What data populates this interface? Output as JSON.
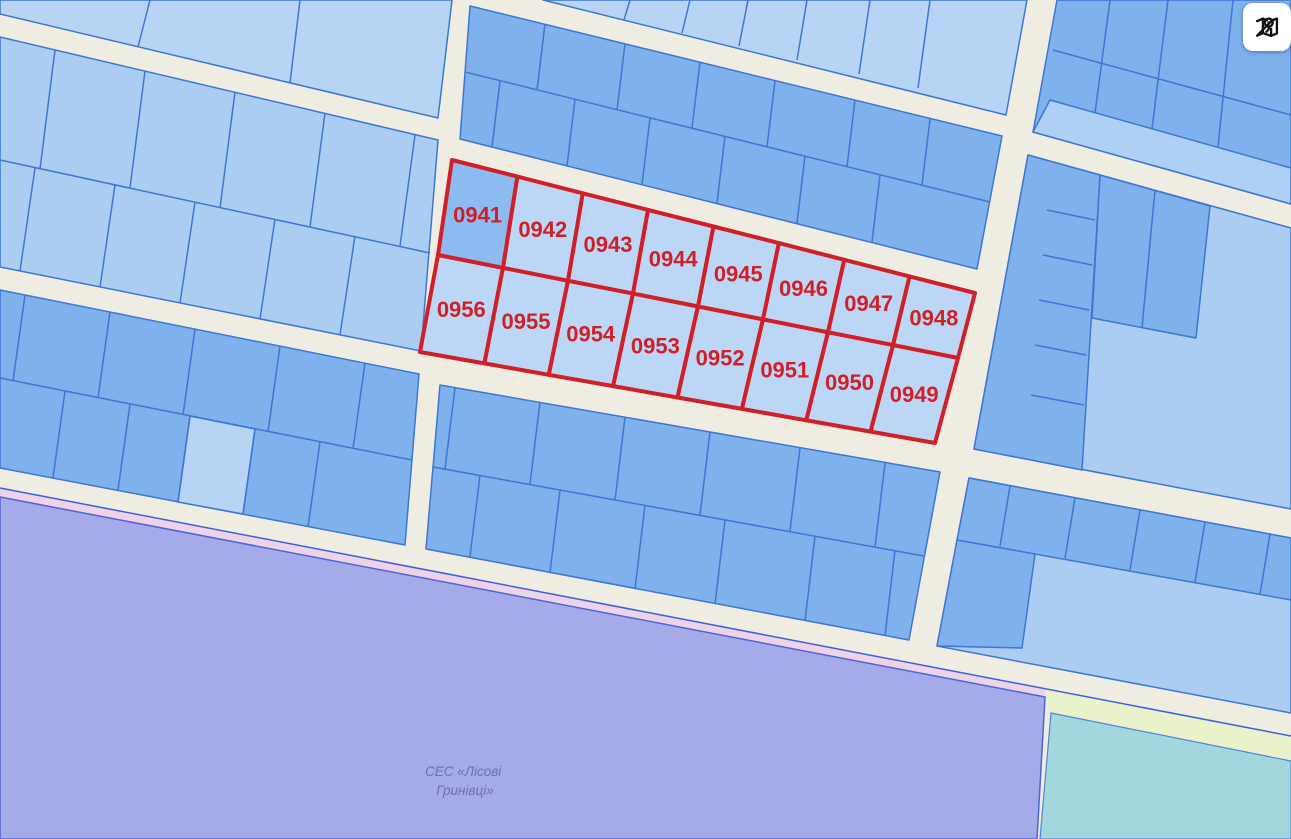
{
  "map": {
    "type": "cadastral-parcel-map",
    "highlighted_parcels": {
      "row1": [
        "0941",
        "0942",
        "0943",
        "0944",
        "0945",
        "0946",
        "0947",
        "0948"
      ],
      "row2": [
        "0956",
        "0955",
        "0954",
        "0953",
        "0952",
        "0951",
        "0950",
        "0949"
      ]
    },
    "zone_label": {
      "line1": "СЕС «Лісові",
      "line2": "Гринівці»"
    },
    "controls": {
      "map_button_icon": "map-with-pin-icon"
    },
    "colors": {
      "road": "#efece2",
      "parcel_light": "#abcdf2",
      "parcel_lighter": "#b7d4f5",
      "parcel_medium": "#7fb1ed",
      "parcel_stroke": "#4076d0",
      "highlight_red": "#d02027",
      "highlight_fill": "#bcd7f6",
      "highlight_fill_dark": "#8cbbf1",
      "zone_purple": "#a5abe8",
      "zone_purple_stroke": "#4f65d2",
      "zone_pink": "#eed3e8",
      "zone_yellow": "#eaf2cb",
      "zone_teal": "#a3d6dd",
      "zone_label_color": "#6d72aa"
    }
  }
}
